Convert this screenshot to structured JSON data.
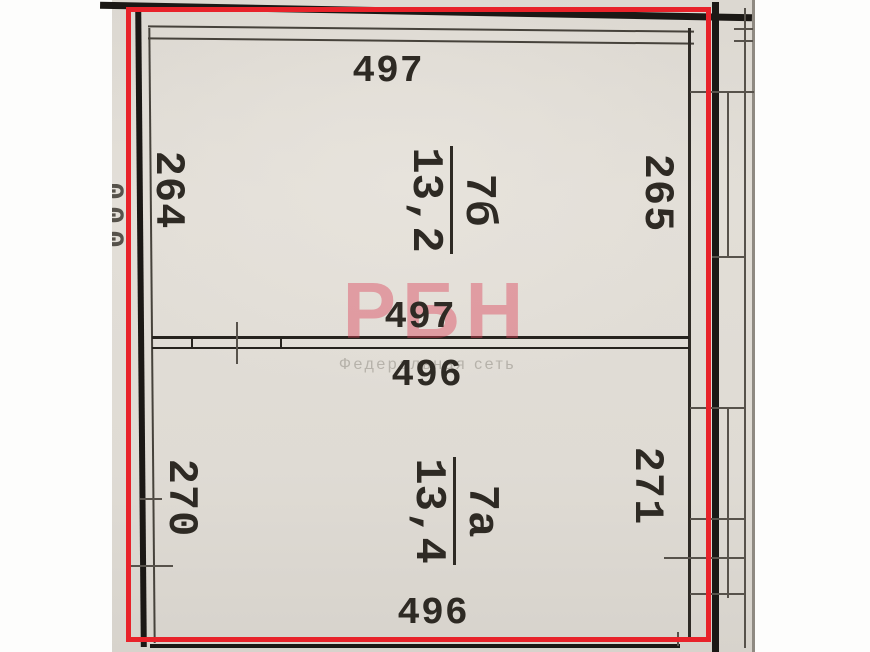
{
  "plan": {
    "highlight_color": "#e8222a",
    "paper_color": "#dfdbd4",
    "ink_color": "#2e2a24",
    "rooms": [
      {
        "number": "7б",
        "area": "13,2",
        "dim_top": "497",
        "dim_bottom": "497",
        "dim_left": "264",
        "dim_right": "265"
      },
      {
        "number": "7а",
        "area": "13,4",
        "dim_top": "496",
        "dim_bottom": "496",
        "dim_left": "270",
        "dim_right": "271"
      }
    ],
    "edge_dimension_clipped": "000"
  },
  "watermark": {
    "brand": "РБН",
    "tagline": "Федеральная сеть",
    "brand_color": "rgba(219,62,86,0.42)",
    "tagline_color": "#b6b2aa"
  }
}
